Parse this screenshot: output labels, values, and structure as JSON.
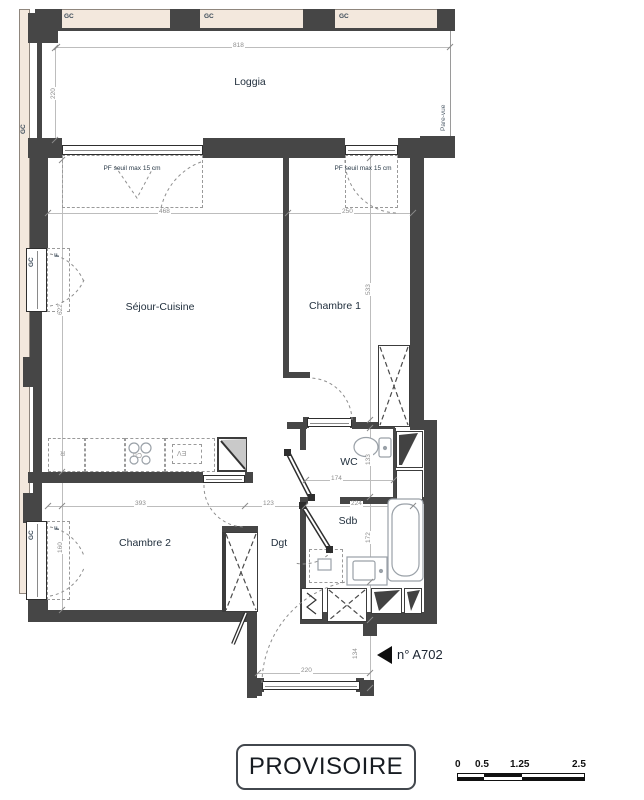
{
  "plan": {
    "stamp": "PROVISOIRE",
    "unit_tag": "n° A702",
    "rooms": [
      {
        "id": "loggia",
        "label": "Loggia"
      },
      {
        "id": "sejour",
        "label": "Séjour-Cuisine"
      },
      {
        "id": "chambre1",
        "label": "Chambre 1"
      },
      {
        "id": "chambre2",
        "label": "Chambre 2"
      },
      {
        "id": "wc",
        "label": "WC"
      },
      {
        "id": "sdb",
        "label": "Sdb"
      },
      {
        "id": "dgt",
        "label": "Dgt"
      }
    ],
    "dims": {
      "loggia_w": "818",
      "loggia_d": "220",
      "sejour_w": "468",
      "ch1_w": "250",
      "sejour_h": "622",
      "ch1_h": "533",
      "ch2_w": "393",
      "dgt_w": "123",
      "wc_w": "174",
      "wc_h": "133",
      "sdb_w": "224",
      "sdb_h": "172",
      "ch2_win": "160",
      "entry_w": "220",
      "entry_d": "134"
    },
    "annotations": {
      "gc": "GC",
      "pare_vue": "Pare-vue",
      "pf_note": "PF seuil max 15 cm",
      "f": "F",
      "kitchen_r": "R",
      "kitchen_cu": "Cu",
      "kitchen_ev": "EV"
    },
    "scale": {
      "labels": [
        "0",
        "0.5",
        "1.25",
        "2.5"
      ]
    },
    "colors": {
      "wall": "#464646",
      "facade_band": "#f3e8dd",
      "dim_text": "#8d8d8d",
      "room_label": "#22303e",
      "stamp_text": "#171c22"
    }
  }
}
